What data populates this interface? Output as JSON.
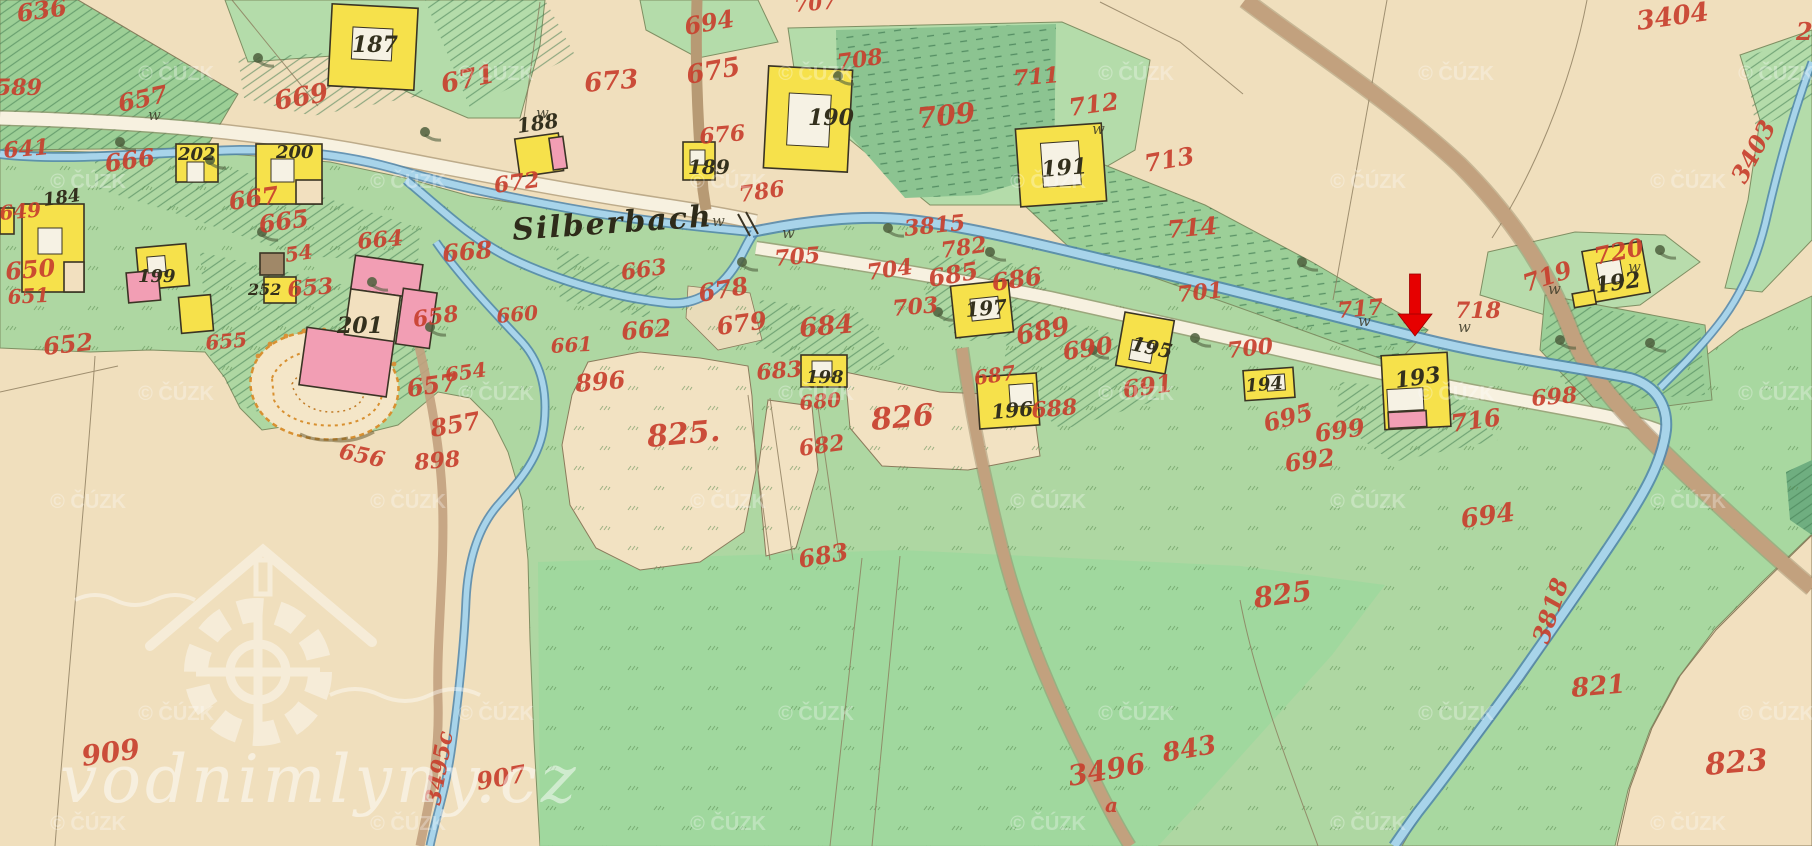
{
  "map": {
    "place_label": "Silberbach",
    "place_label_pos": {
      "x": 513,
      "y": 240,
      "size": 30,
      "rot": -4
    },
    "watermark": {
      "site": "vodnimlyny.cz",
      "copyright": "© ČÚZK",
      "grid_a": {
        "ys": [
          80,
          400,
          720
        ],
        "xs": [
          176,
          496,
          816,
          1136,
          1456,
          1776
        ]
      },
      "grid_b": {
        "ys": [
          188,
          508,
          830
        ],
        "xs": [
          88,
          408,
          728,
          1048,
          1368,
          1688
        ]
      }
    },
    "marker": {
      "shape": "red-arrow",
      "x": 1415,
      "y_top": 274,
      "y_tip": 336,
      "shaft_w": 11,
      "head_w": 34,
      "head_h": 22,
      "color": "#e60000",
      "points_to_house": "193"
    },
    "colors": {
      "paper": "#f2e0bf",
      "field_green": "#aed7a2",
      "bright_green": "#9cd89e",
      "hatch_green": "#3f7a50",
      "stream_fill": "#a8d4ea",
      "stream_edge": "#4f86ad",
      "road_fill": "#f7f1e0",
      "road_edge": "#8a7757",
      "track_brown": "#c2a17e",
      "building_yellow": "#f6e14b",
      "building_pink": "#f29eb4",
      "outline": "#3a3424",
      "number_red": "#c8402e",
      "number_black": "#33301d",
      "quarry_orange": "#dd8c2f"
    },
    "red_parcel_numbers": [
      [
        "636",
        18,
        22,
        24,
        -8
      ],
      [
        "589",
        -4,
        95,
        22,
        0
      ],
      [
        "657",
        120,
        112,
        24,
        -12
      ],
      [
        "669",
        276,
        110,
        26,
        -10
      ],
      [
        "641",
        4,
        158,
        22,
        -5
      ],
      [
        "666",
        106,
        172,
        24,
        -8
      ],
      [
        "667",
        230,
        210,
        24,
        -8
      ],
      [
        "665",
        260,
        233,
        24,
        -8
      ],
      [
        "664",
        358,
        249,
        22,
        -5
      ],
      [
        "54",
        286,
        262,
        20,
        -8
      ],
      [
        "649",
        0,
        220,
        20,
        -5
      ],
      [
        "650",
        6,
        280,
        24,
        -5
      ],
      [
        "651",
        8,
        304,
        20,
        -3
      ],
      [
        "652",
        44,
        355,
        24,
        -6
      ],
      [
        "653",
        288,
        297,
        22,
        -5
      ],
      [
        "655",
        206,
        350,
        20,
        -5
      ],
      [
        "654",
        446,
        382,
        20,
        -8
      ],
      [
        "657",
        408,
        397,
        24,
        -8
      ],
      [
        "658",
        414,
        327,
        22,
        -8
      ],
      [
        "660",
        497,
        323,
        20,
        -5
      ],
      [
        "661",
        551,
        353,
        20,
        -3
      ],
      [
        "662",
        622,
        340,
        24,
        -5
      ],
      [
        "663",
        622,
        280,
        22,
        -8
      ],
      [
        "656",
        338,
        458,
        22,
        12
      ],
      [
        "896",
        576,
        392,
        24,
        -5
      ],
      [
        "898",
        415,
        470,
        22,
        -5
      ],
      [
        "857",
        432,
        437,
        24,
        -10
      ],
      [
        "909",
        83,
        766,
        28,
        -8
      ],
      [
        "907",
        478,
        790,
        24,
        -10
      ],
      [
        "3495c",
        440,
        806,
        22,
        -80
      ],
      [
        "825.",
        648,
        447,
        30,
        -5
      ],
      [
        "826",
        872,
        430,
        30,
        -5
      ],
      [
        "683",
        757,
        380,
        22,
        -5
      ],
      [
        "680",
        800,
        410,
        20,
        -5
      ],
      [
        "682",
        800,
        456,
        22,
        -8
      ],
      [
        "683",
        800,
        568,
        24,
        -10
      ],
      [
        "688",
        1032,
        418,
        22,
        -5
      ],
      [
        "687",
        975,
        385,
        20,
        -8
      ],
      [
        "689",
        1018,
        345,
        26,
        -12
      ],
      [
        "690",
        1064,
        360,
        24,
        -8
      ],
      [
        "691",
        1124,
        398,
        24,
        -8
      ],
      [
        "684",
        800,
        337,
        26,
        -5
      ],
      [
        "678",
        700,
        302,
        24,
        -10
      ],
      [
        "679",
        718,
        335,
        24,
        -8
      ],
      [
        "672",
        495,
        193,
        22,
        -8
      ],
      [
        "671",
        443,
        93,
        26,
        -12
      ],
      [
        "673",
        585,
        92,
        26,
        -5
      ],
      [
        "675",
        688,
        84,
        26,
        -10
      ],
      [
        "694",
        686,
        35,
        24,
        -10
      ],
      [
        "707",
        795,
        12,
        20,
        -5
      ],
      [
        "708",
        838,
        70,
        22,
        -8
      ],
      [
        "709",
        918,
        128,
        28,
        -6
      ],
      [
        "711",
        1014,
        86,
        22,
        -5
      ],
      [
        "712",
        1070,
        116,
        24,
        -8
      ],
      [
        "713",
        1146,
        172,
        24,
        -10
      ],
      [
        "714",
        1168,
        238,
        24,
        -5
      ],
      [
        "3815",
        905,
        236,
        22,
        -6
      ],
      [
        "786",
        740,
        202,
        22,
        -8
      ],
      [
        "676",
        700,
        144,
        22,
        -5
      ],
      [
        "668",
        443,
        262,
        24,
        -5
      ],
      [
        "705",
        775,
        266,
        22,
        -5
      ],
      [
        "704",
        868,
        280,
        22,
        -8
      ],
      [
        "782",
        942,
        258,
        22,
        -8
      ],
      [
        "703",
        893,
        316,
        22,
        -5
      ],
      [
        "685",
        930,
        287,
        24,
        -10
      ],
      [
        "686",
        993,
        291,
        24,
        -8
      ],
      [
        "701",
        1178,
        302,
        22,
        -6
      ],
      [
        "700",
        1228,
        358,
        22,
        -6
      ],
      [
        "717",
        1338,
        318,
        22,
        -5
      ],
      [
        "718",
        1455,
        318,
        22,
        0
      ],
      [
        "719",
        1526,
        292,
        24,
        -18
      ],
      [
        "720",
        1596,
        265,
        24,
        -12
      ],
      [
        "716",
        1452,
        432,
        24,
        -8
      ],
      [
        "698",
        1532,
        406,
        22,
        -5
      ],
      [
        "695",
        1266,
        432,
        24,
        -15
      ],
      [
        "699",
        1316,
        442,
        24,
        -8
      ],
      [
        "692",
        1286,
        472,
        24,
        -8
      ],
      [
        "3404",
        1638,
        30,
        26,
        -8
      ],
      [
        "3403",
        1745,
        185,
        24,
        -62
      ],
      [
        "2",
        1796,
        40,
        24,
        0
      ],
      [
        "694",
        1462,
        528,
        26,
        -8
      ],
      [
        "3818",
        1548,
        645,
        24,
        -72
      ],
      [
        "821",
        1572,
        697,
        26,
        -5
      ],
      [
        "825",
        1255,
        608,
        28,
        -8
      ],
      [
        "843",
        1164,
        762,
        26,
        -10
      ],
      [
        "3496",
        1070,
        786,
        28,
        -10
      ],
      [
        "a",
        1105,
        812,
        20,
        0
      ],
      [
        "823",
        1706,
        775,
        30,
        -5
      ]
    ],
    "black_house_numbers": [
      [
        "187",
        352,
        52,
        22,
        0
      ],
      [
        "188",
        518,
        133,
        20,
        -8
      ],
      [
        "189",
        688,
        174,
        20,
        0
      ],
      [
        "190",
        808,
        125,
        22,
        0
      ],
      [
        "191",
        1042,
        177,
        22,
        -5
      ],
      [
        "192",
        1596,
        293,
        22,
        -8
      ],
      [
        "193",
        1396,
        388,
        22,
        -8
      ],
      [
        "194",
        1246,
        392,
        18,
        -5
      ],
      [
        "195",
        1130,
        350,
        20,
        12
      ],
      [
        "196",
        992,
        419,
        20,
        -5
      ],
      [
        "197",
        966,
        317,
        20,
        -5
      ],
      [
        "198",
        806,
        383,
        18,
        0
      ],
      [
        "199",
        138,
        282,
        18,
        0
      ],
      [
        "200",
        276,
        158,
        18,
        0
      ],
      [
        "201",
        337,
        333,
        22,
        0
      ],
      [
        "202",
        178,
        160,
        18,
        0
      ],
      [
        "184",
        44,
        206,
        18,
        -8
      ],
      [
        "252",
        248,
        295,
        16,
        0
      ]
    ],
    "buildings": [
      {
        "n": "187",
        "rot": 3,
        "cx": 373,
        "cy": 47,
        "parts": [
          [
            "y",
            330,
            6,
            86,
            82
          ],
          [
            "w",
            352,
            28,
            40,
            32
          ]
        ]
      },
      {
        "n": "188",
        "rot": -8,
        "cx": 538,
        "cy": 154,
        "parts": [
          [
            "y",
            517,
            136,
            44,
            38
          ],
          [
            "p",
            551,
            140,
            14,
            32
          ]
        ]
      },
      {
        "n": "189",
        "parts": [
          [
            "y",
            683,
            142,
            32,
            38
          ],
          [
            "w",
            690,
            150,
            15,
            15
          ]
        ]
      },
      {
        "n": "190",
        "rot": 3,
        "cx": 808,
        "cy": 119,
        "parts": [
          [
            "y",
            766,
            68,
            84,
            102
          ],
          [
            "w",
            788,
            94,
            42,
            52
          ]
        ]
      },
      {
        "n": "191",
        "rot": -4,
        "cx": 1061,
        "cy": 165,
        "parts": [
          [
            "y",
            1018,
            126,
            86,
            78
          ],
          [
            "w",
            1042,
            142,
            38,
            44
          ]
        ]
      },
      {
        "n": "202",
        "parts": [
          [
            "y",
            176,
            144,
            42,
            38
          ],
          [
            "w",
            187,
            162,
            17,
            20
          ]
        ]
      },
      {
        "n": "200",
        "parts": [
          [
            "y",
            256,
            144,
            66,
            60
          ],
          [
            "c",
            296,
            180,
            26,
            24
          ],
          [
            "w",
            271,
            159,
            23,
            23
          ]
        ]
      },
      {
        "n": "184",
        "parts": [
          [
            "y",
            22,
            204,
            62,
            88
          ],
          [
            "c",
            64,
            262,
            20,
            30
          ],
          [
            "w",
            38,
            228,
            24,
            26
          ]
        ]
      },
      {
        "n": "199",
        "rot": -5,
        "cx": 160,
        "cy": 270,
        "parts": [
          [
            "y",
            138,
            246,
            50,
            42
          ],
          [
            "p",
            126,
            270,
            32,
            30
          ],
          [
            "w",
            148,
            256,
            18,
            16
          ]
        ]
      },
      {
        "rot": -5,
        "cx": 196,
        "cy": 314,
        "parts": [
          [
            "y",
            180,
            296,
            32,
            36
          ]
        ]
      },
      {
        "n": "252",
        "parts": [
          [
            "b",
            260,
            253,
            24,
            22
          ],
          [
            "y",
            264,
            277,
            32,
            26
          ]
        ]
      },
      {
        "n": "201",
        "rot": 8,
        "cx": 370,
        "cy": 325,
        "parts": [
          [
            "p",
            346,
            258,
            68,
            34
          ],
          [
            "p",
            398,
            284,
            34,
            56
          ],
          [
            "p",
            308,
            336,
            88,
            58
          ],
          [
            "c",
            346,
            292,
            50,
            46
          ]
        ]
      },
      {
        "n": "197",
        "rot": -6,
        "cx": 982,
        "cy": 309,
        "parts": [
          [
            "y",
            953,
            283,
            58,
            52
          ],
          [
            "w",
            971,
            298,
            28,
            22
          ]
        ]
      },
      {
        "n": "198",
        "parts": [
          [
            "y",
            801,
            355,
            46,
            32
          ],
          [
            "w",
            812,
            361,
            20,
            16
          ]
        ]
      },
      {
        "n": "196",
        "rot": -4,
        "cx": 1008,
        "cy": 401,
        "parts": [
          [
            "y",
            978,
            375,
            60,
            52
          ],
          [
            "w",
            1010,
            385,
            24,
            22
          ]
        ]
      },
      {
        "n": "195",
        "rot": 10,
        "cx": 1145,
        "cy": 343,
        "parts": [
          [
            "y",
            1120,
            316,
            50,
            54
          ],
          [
            "w",
            1132,
            342,
            22,
            20
          ]
        ]
      },
      {
        "n": "194",
        "rot": -4,
        "cx": 1269,
        "cy": 384,
        "parts": [
          [
            "y",
            1244,
            369,
            50,
            30
          ],
          [
            "w",
            1267,
            375,
            18,
            16
          ]
        ]
      },
      {
        "n": "193",
        "rot": -3,
        "cx": 1416,
        "cy": 391,
        "parts": [
          [
            "y",
            1383,
            354,
            66,
            74
          ],
          [
            "w",
            1387,
            388,
            36,
            22
          ],
          [
            "p",
            1387,
            411,
            38,
            16
          ]
        ]
      },
      {
        "n": "192",
        "rot": -10,
        "cx": 1616,
        "cy": 272,
        "parts": [
          [
            "y",
            1586,
            246,
            60,
            52
          ],
          [
            "w",
            1598,
            260,
            24,
            22
          ],
          [
            "y",
            1569,
            286,
            22,
            14
          ]
        ]
      },
      {
        "parts": [
          [
            "y",
            0,
            208,
            14,
            26
          ]
        ]
      }
    ],
    "symbols": {
      "trees": [
        [
          120,
          142
        ],
        [
          258,
          58
        ],
        [
          425,
          132
        ],
        [
          262,
          232
        ],
        [
          372,
          282
        ],
        [
          430,
          327
        ],
        [
          888,
          228
        ],
        [
          838,
          76
        ],
        [
          990,
          252
        ],
        [
          1195,
          338
        ],
        [
          1560,
          340
        ],
        [
          1650,
          343
        ],
        [
          1302,
          262
        ],
        [
          742,
          262
        ],
        [
          938,
          312
        ],
        [
          1093,
          350
        ],
        [
          210,
          160
        ],
        [
          1660,
          250
        ]
      ],
      "meadow_marks": [
        [
          148,
          120
        ],
        [
          712,
          226
        ],
        [
          782,
          238
        ],
        [
          1358,
          326
        ],
        [
          1548,
          294
        ],
        [
          1628,
          272
        ],
        [
          1092,
          134
        ],
        [
          536,
          118
        ],
        [
          1458,
          332
        ]
      ]
    }
  }
}
